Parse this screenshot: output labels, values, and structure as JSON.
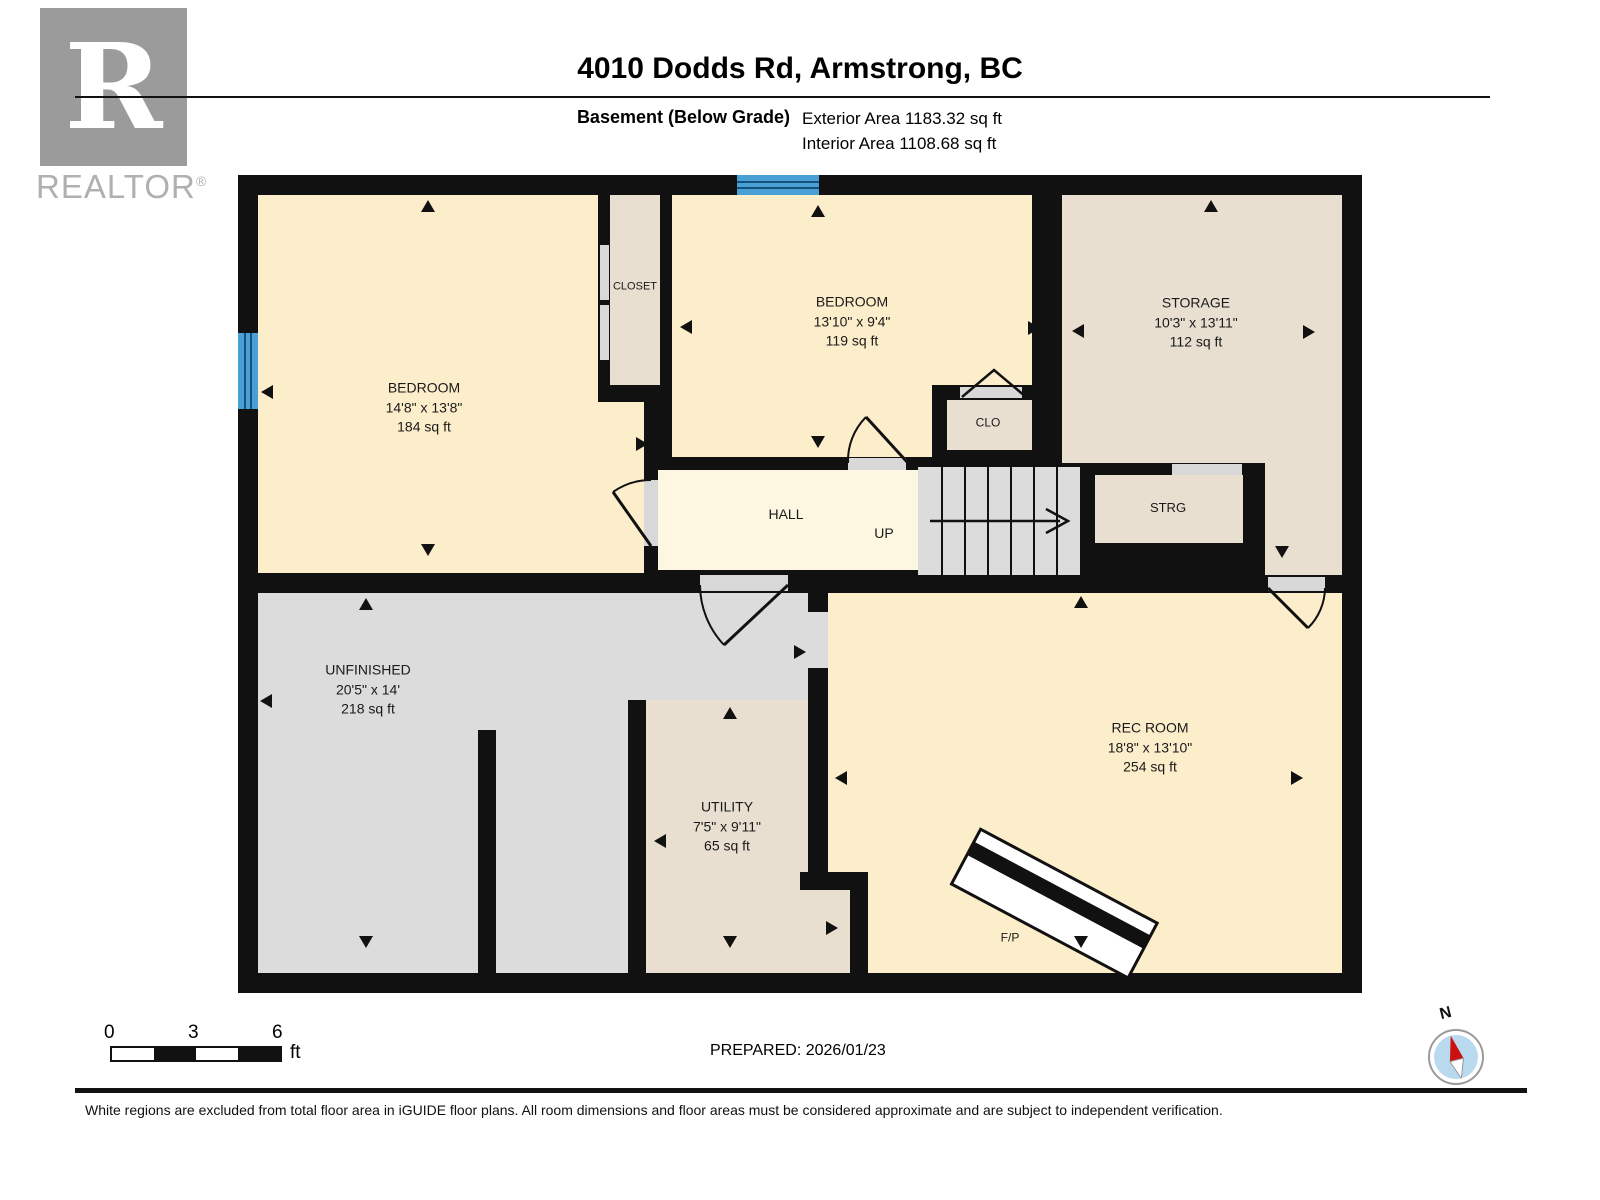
{
  "header": {
    "logo_text": "REALTOR",
    "logo_reg": "®",
    "title": "4010 Dodds Rd, Armstrong, BC",
    "floor_label": "Basement (Below Grade)",
    "exterior_area": "Exterior Area 1183.32 sq ft",
    "interior_area": "Interior Area 1108.68 sq ft"
  },
  "rooms": {
    "bedroom1": {
      "name": "BEDROOM",
      "dims": "14'8\" x 13'8\"",
      "area": "184 sq ft"
    },
    "closet": {
      "name": "CLOSET"
    },
    "bedroom2": {
      "name": "BEDROOM",
      "dims": "13'10\" x 9'4\"",
      "area": "119 sq ft"
    },
    "storage": {
      "name": "STORAGE",
      "dims": "10'3\" x 13'11\"",
      "area": "112 sq ft"
    },
    "clo": {
      "name": "CLO"
    },
    "hall": {
      "name": "HALL"
    },
    "stairs": {
      "label": "UP"
    },
    "strg": {
      "name": "STRG"
    },
    "unfinished": {
      "name": "UNFINISHED",
      "dims": "20'5\" x 14'",
      "area": "218 sq ft"
    },
    "utility": {
      "name": "UTILITY",
      "dims": "7'5\" x 9'11\"",
      "area": "65 sq ft"
    },
    "recroom": {
      "name": "REC ROOM",
      "dims": "18'8\" x 13'10\"",
      "area": "254 sq ft"
    },
    "fireplace": {
      "name": "F/P"
    }
  },
  "scale_bar": {
    "labels": [
      "0",
      "3",
      "6"
    ],
    "unit": "ft"
  },
  "compass": {
    "label": "N"
  },
  "footer": {
    "prepared": "PREPARED: 2026/01/23",
    "disclaimer": "White regions are excluded from total floor area in iGUIDE floor plans. All room dimensions and floor areas must be considered approximate and are subject to independent verification."
  },
  "colors": {
    "room_yellow": "#fdeecb",
    "hall_yellow": "#fdf7e2",
    "excluded_tan": "#e8dfd0",
    "unfinished_gray": "#dcdcdc",
    "window_blue": "#4aa0d4",
    "wall_black": "#111111"
  }
}
